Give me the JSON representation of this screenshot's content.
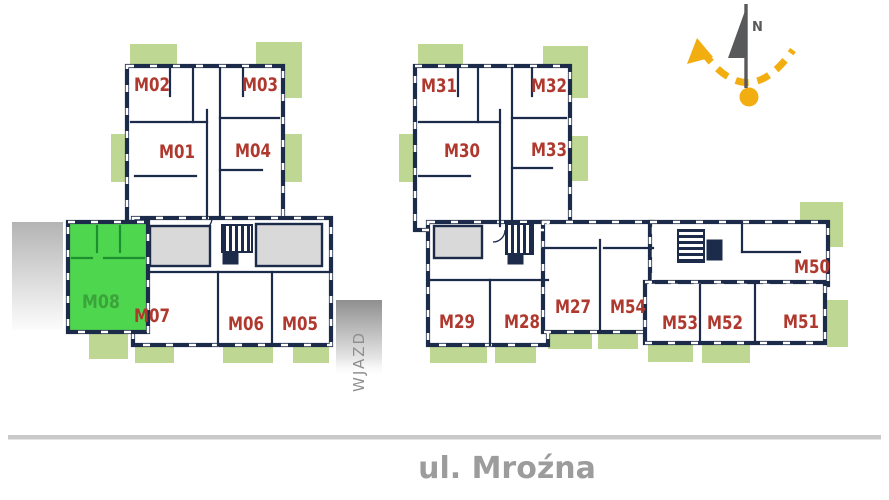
{
  "street_label": "ul. Mroźna",
  "driveway_label": "WJAZD",
  "compass_north": "N",
  "selected_unit": "M08",
  "buildings": [
    {
      "id": "building-left",
      "units": [
        "M01",
        "M02",
        "M03",
        "M04",
        "M05",
        "M06",
        "M07",
        "M08"
      ]
    },
    {
      "id": "building-right",
      "units": [
        "M27",
        "M28",
        "M29",
        "M30",
        "M31",
        "M32",
        "M33",
        "M50",
        "M51",
        "M52",
        "M53",
        "M54"
      ]
    }
  ],
  "units": {
    "M01": {
      "label": "M01"
    },
    "M02": {
      "label": "M02"
    },
    "M03": {
      "label": "M03"
    },
    "M04": {
      "label": "M04"
    },
    "M05": {
      "label": "M05"
    },
    "M06": {
      "label": "M06"
    },
    "M07": {
      "label": "M07"
    },
    "M08": {
      "label": "M08",
      "selected": true
    },
    "M27": {
      "label": "M27"
    },
    "M28": {
      "label": "M28"
    },
    "M29": {
      "label": "M29"
    },
    "M30": {
      "label": "M30"
    },
    "M31": {
      "label": "M31"
    },
    "M32": {
      "label": "M32"
    },
    "M33": {
      "label": "M33"
    },
    "M50": {
      "label": "M50"
    },
    "M51": {
      "label": "M51"
    },
    "M52": {
      "label": "M52"
    },
    "M53": {
      "label": "M53"
    },
    "M54": {
      "label": "M54"
    }
  },
  "colors": {
    "wall": "#1c2b4a",
    "unit-label": "#b0392f",
    "selected-fill": "#4fd64f",
    "selected-wall-line": "#1e8f2e",
    "selected-label": "#3aa43a",
    "balcony": "#bed792",
    "common-area": "#d9d9d9",
    "accent-yellow": "#f2ae11",
    "street-gray": "#9c9c9c"
  }
}
